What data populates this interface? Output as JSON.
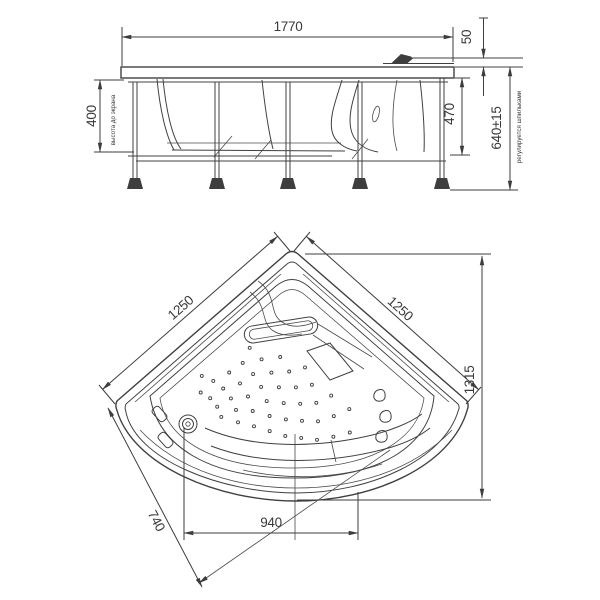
{
  "drawing": {
    "side_view": {
      "width_label": "1770",
      "rim_height_label": "50",
      "apron_height_label": "400",
      "apron_note": "высота до экрана",
      "frame_height_label": "470",
      "total_height_label": "640±15",
      "total_height_note": "регулируется шпильками"
    },
    "plan_view": {
      "left_edge_label": "1250",
      "right_edge_label": "1250",
      "depth_label": "1315",
      "bottom_width_label": "940",
      "drain_offset_label": "740"
    }
  }
}
